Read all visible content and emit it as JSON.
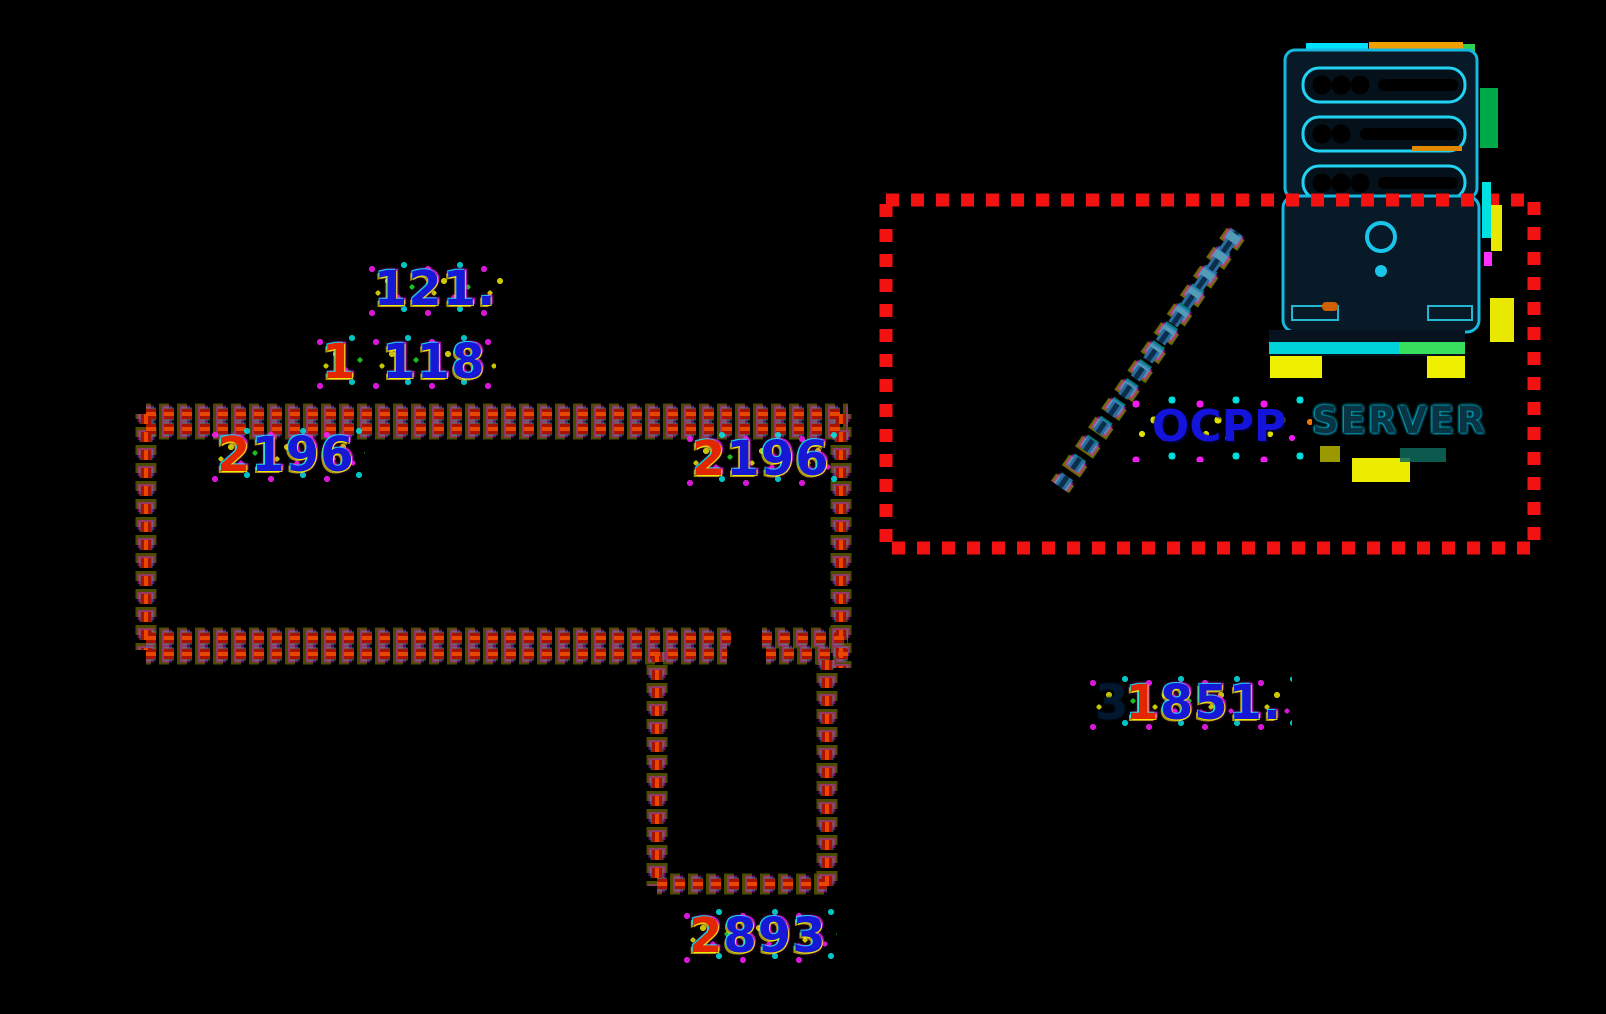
{
  "canvas": {
    "width": 1606,
    "height": 1014,
    "background": "#000000"
  },
  "labels": {
    "dim_121": {
      "blue": "121."
    },
    "dim_118": {
      "red": "1",
      "blue": "118"
    },
    "dim_2196_left": {
      "red": "2",
      "blue": "196"
    },
    "dim_2196_right": {
      "red": "2",
      "blue": "196"
    },
    "dim_1851": {
      "ghost": "3",
      "red": "1",
      "blue": "851."
    },
    "dim_2893": {
      "red": "2",
      "blue": "893"
    }
  },
  "server_box": {
    "ocpp_label": "OCPP",
    "server_label": "SERVER"
  },
  "icons": [
    "server-tower-icon",
    "connection-chain-icon"
  ],
  "colors": {
    "digit_blue": "#1717d6",
    "digit_red": "#e42600",
    "dash_red": "#a81200",
    "boundary_red": "#f21212",
    "icon_cyan": "#19c6ea",
    "glitch_yellow": "#ecec00",
    "glitch_magenta": "#ff1cff",
    "glitch_cyan": "#00e6e6",
    "ocpp_text": "#1313d9",
    "server_text": "#083444"
  }
}
